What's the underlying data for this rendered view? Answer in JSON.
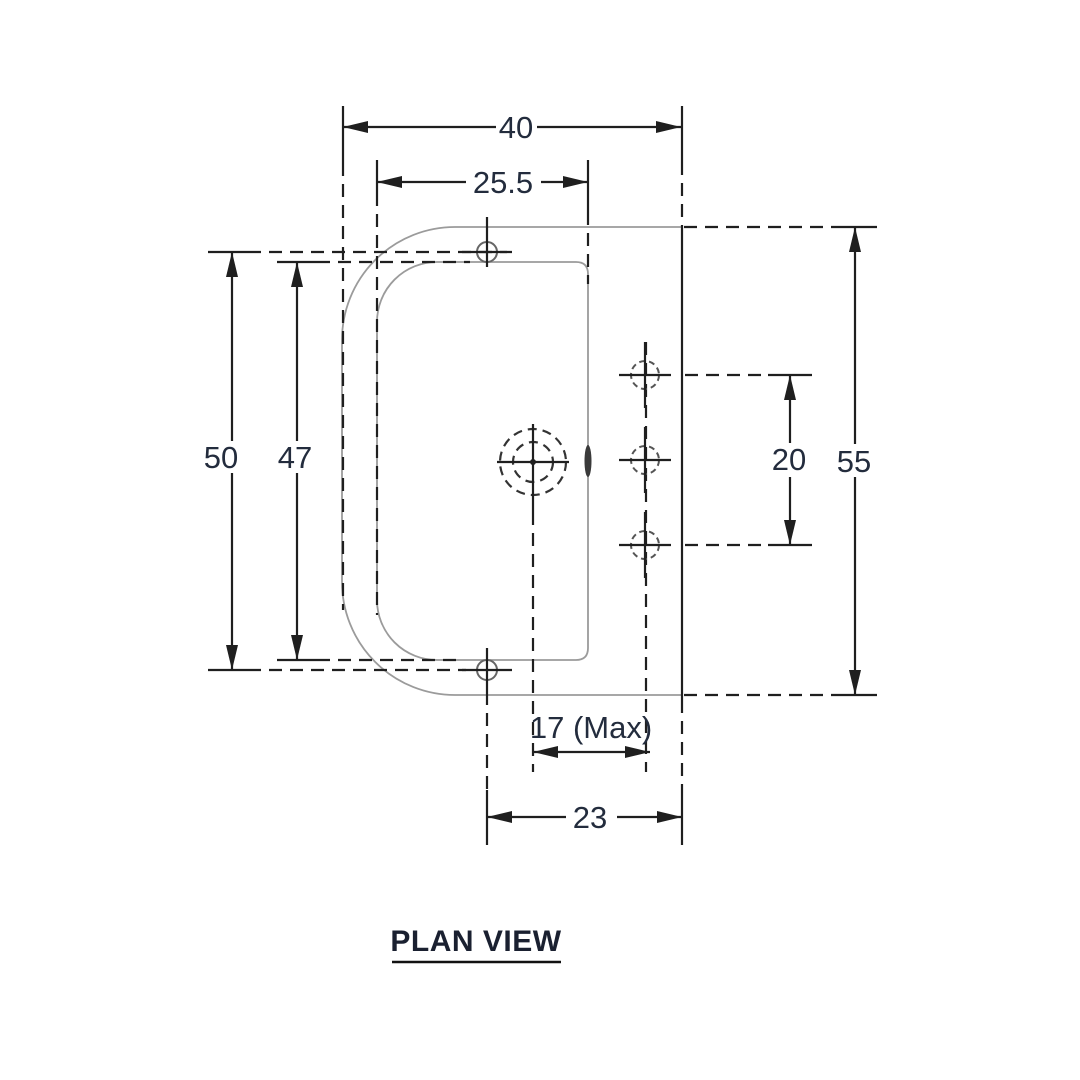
{
  "title": "PLAN VIEW",
  "view_type": "engineering-plan-view-drawing",
  "dims": {
    "overall_width": "40",
    "inner_width": "25.5",
    "outer_height_left": "50",
    "inner_height": "47",
    "overall_height": "55",
    "hole_pitch": "20",
    "max_depth": "17 (Max)",
    "plate_offset": "23"
  },
  "colors": {
    "dimension_lines": "#1f1f1f",
    "part_outline": "#9b9b9b",
    "dimension_text": "#232c3d",
    "background": "#ffffff"
  }
}
